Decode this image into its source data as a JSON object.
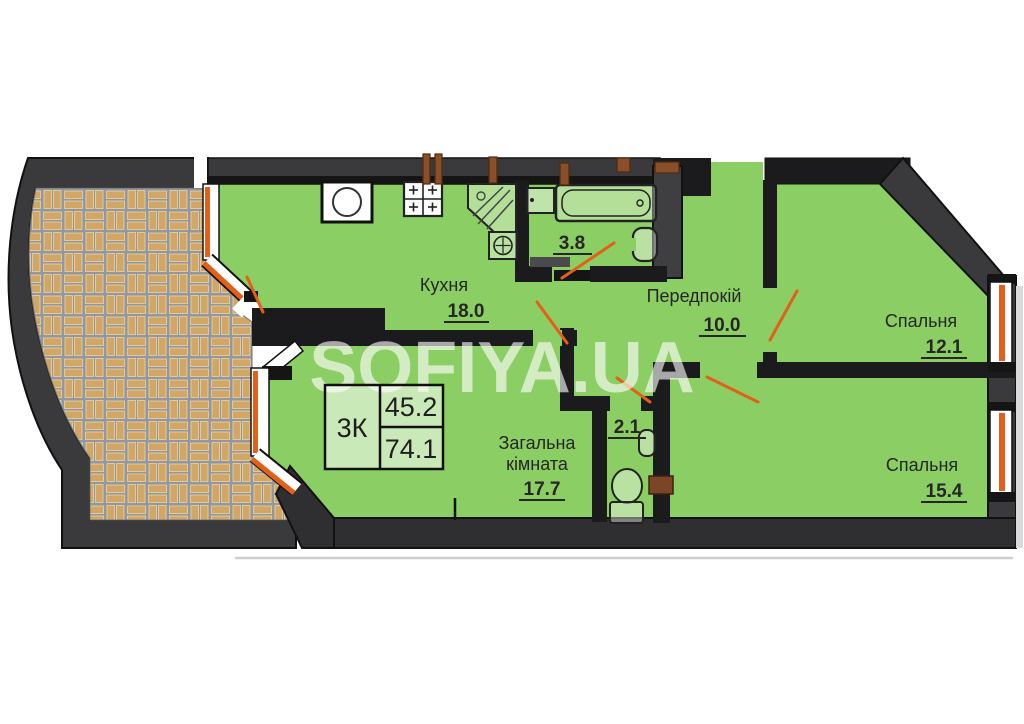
{
  "watermark": "SOFIYA.UA",
  "info_table": {
    "apartment_type": "3К",
    "living_area": "45.2",
    "total_area": "74.1"
  },
  "rooms": {
    "kitchen": {
      "name": "Кухня",
      "area": "18.0"
    },
    "bathroom": {
      "area": "3.8"
    },
    "hallway": {
      "name": "Передпокій",
      "area": "10.0"
    },
    "bedroom_top": {
      "name": "Спальня",
      "area": "12.1"
    },
    "bedroom_bottom": {
      "name": "Спальня",
      "area": "15.4"
    },
    "living_room": {
      "name_line1": "Загальна",
      "name_line2": "кімната",
      "area": "17.7"
    },
    "wc": {
      "area": "2.1"
    }
  },
  "colors": {
    "room_fill": "#8bce63",
    "wall_dark": "#3a3a3c",
    "wall_black": "#1b1b1d",
    "window_orange": "#e2601a",
    "terrace_brick": "#d2a766",
    "terrace_mortar": "#94989c"
  }
}
